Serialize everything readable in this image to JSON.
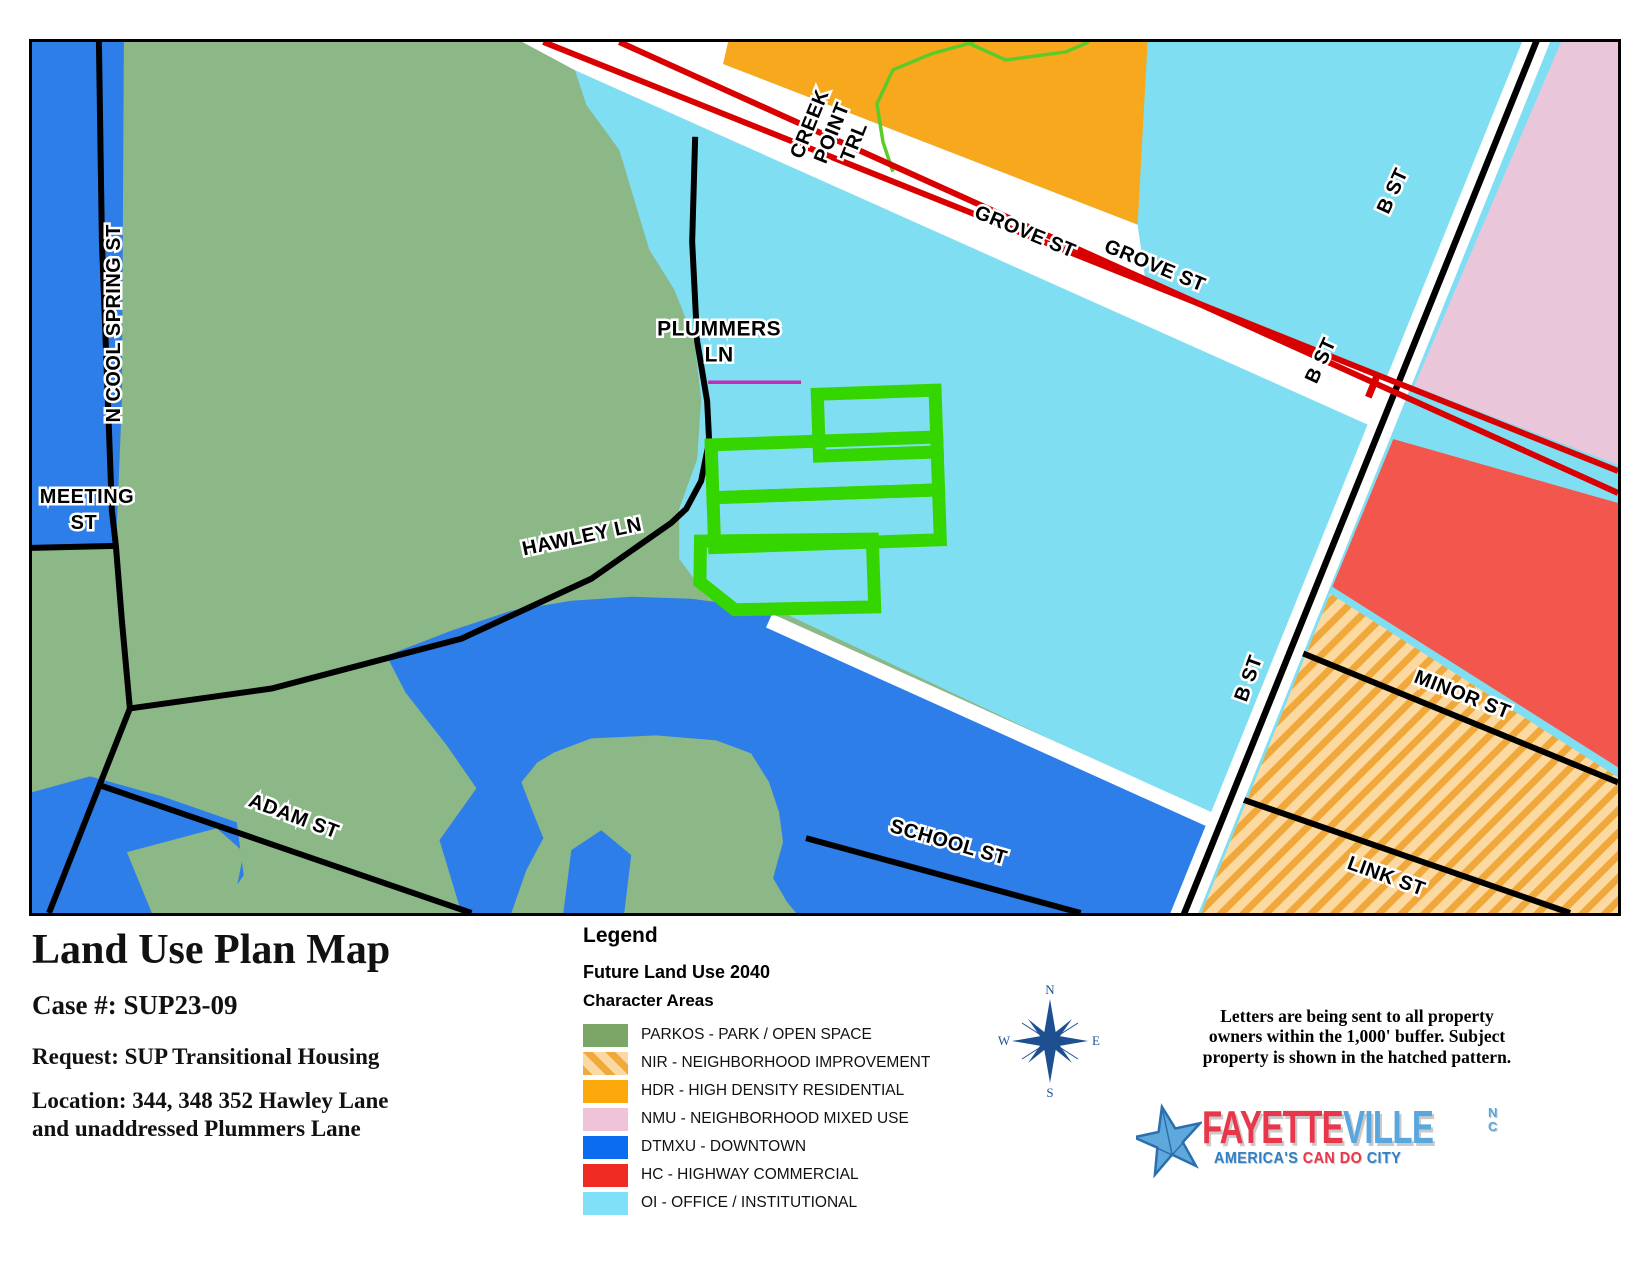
{
  "palette": {
    "parkos": "#8CB787",
    "dtmxu": "#2E7EE9",
    "oi": "#80DEF2",
    "hdr": "#F8A81D",
    "nmu": "#EAC6DB",
    "hc": "#F3564D",
    "nir_base": "#FBD9A0",
    "nir_stripe": "#F1A83B",
    "subject": "#35D600",
    "rail": "#D80000",
    "trail": "#5BCB29",
    "magenta": "#C32BB8",
    "road": "#000000",
    "casing": "#FFFFFF",
    "compass": "#1D4F91",
    "star_fill": "#5FA8DC",
    "star_edge": "#2C6FB0"
  },
  "map": {
    "labels": {
      "n_cool_spring": "N COOL SPRING ST",
      "meeting_1": "MEETING",
      "meeting_2": "ST",
      "creek_1": "CREEK",
      "creek_2": "POINT",
      "creek_3": "TRL",
      "grove_a": "GROVE ST",
      "grove_b": "GROVE ST",
      "plummers_1": "PLUMMERS",
      "plummers_2": "LN",
      "hawley": "HAWLEY LN",
      "b_st_a": "B ST",
      "b_st_b": "B ST",
      "b_st_c": "B ST",
      "minor": "MINOR ST",
      "link": "LINK ST",
      "school": "SCHOOL ST",
      "adam": "ADAM ST"
    }
  },
  "info": {
    "title": "Land Use Plan Map",
    "case_label": "Case #: SUP23-09",
    "request": "Request: SUP Transitional Housing",
    "location_line1": "Location:  344, 348 352 Hawley Lane",
    "location_line2": "and unaddressed Plummers Lane"
  },
  "legend": {
    "heading": "Legend",
    "subheading": "Future Land Use 2040",
    "section": "Character Areas",
    "items": [
      {
        "label": "PARKOS - PARK / OPEN SPACE",
        "color": "#7CA667",
        "swatch_css": "background:#7CA667"
      },
      {
        "label": "NIR - NEIGHBORHOOD IMPROVEMENT",
        "color": "#F2A93C",
        "swatch_css": "background:repeating-linear-gradient(45deg,#F2A93C 0px 7px,#FBD9A4 7px 16px)"
      },
      {
        "label": "HDR - HIGH DENSITY RESIDENTIAL",
        "color": "#FCA70A",
        "swatch_css": "background:#FCA70A"
      },
      {
        "label": "NMU - NEIGHBORHOOD MIXED USE",
        "color": "#EFC3D8",
        "swatch_css": "background:#EFC3D8"
      },
      {
        "label": "DTMXU - DOWNTOWN",
        "color": "#0B6CF0",
        "swatch_css": "background:#0B6CF0"
      },
      {
        "label": "HC - HIGHWAY COMMERCIAL",
        "color": "#EF2B24",
        "swatch_css": "background:#EF2B24"
      },
      {
        "label": "OI - OFFICE / INSTITUTIONAL",
        "color": "#7FE0F7",
        "swatch_css": "background:#7FE0F7"
      }
    ]
  },
  "compass": {
    "n": "N",
    "e": "E",
    "s": "S",
    "w": "W"
  },
  "note": {
    "line1": "Letters are being sent to all property",
    "line2": "owners within the 1,000' buffer.  Subject",
    "line3": "property is shown in the hatched pattern."
  },
  "logo": {
    "fayette": "FAYETTE",
    "ville": "VILLE",
    "nc_top": "N",
    "nc_bottom": "C",
    "tagline_a": "AMERICA'S",
    "tagline_b": "CAN DO",
    "tagline_c": "CITY"
  }
}
